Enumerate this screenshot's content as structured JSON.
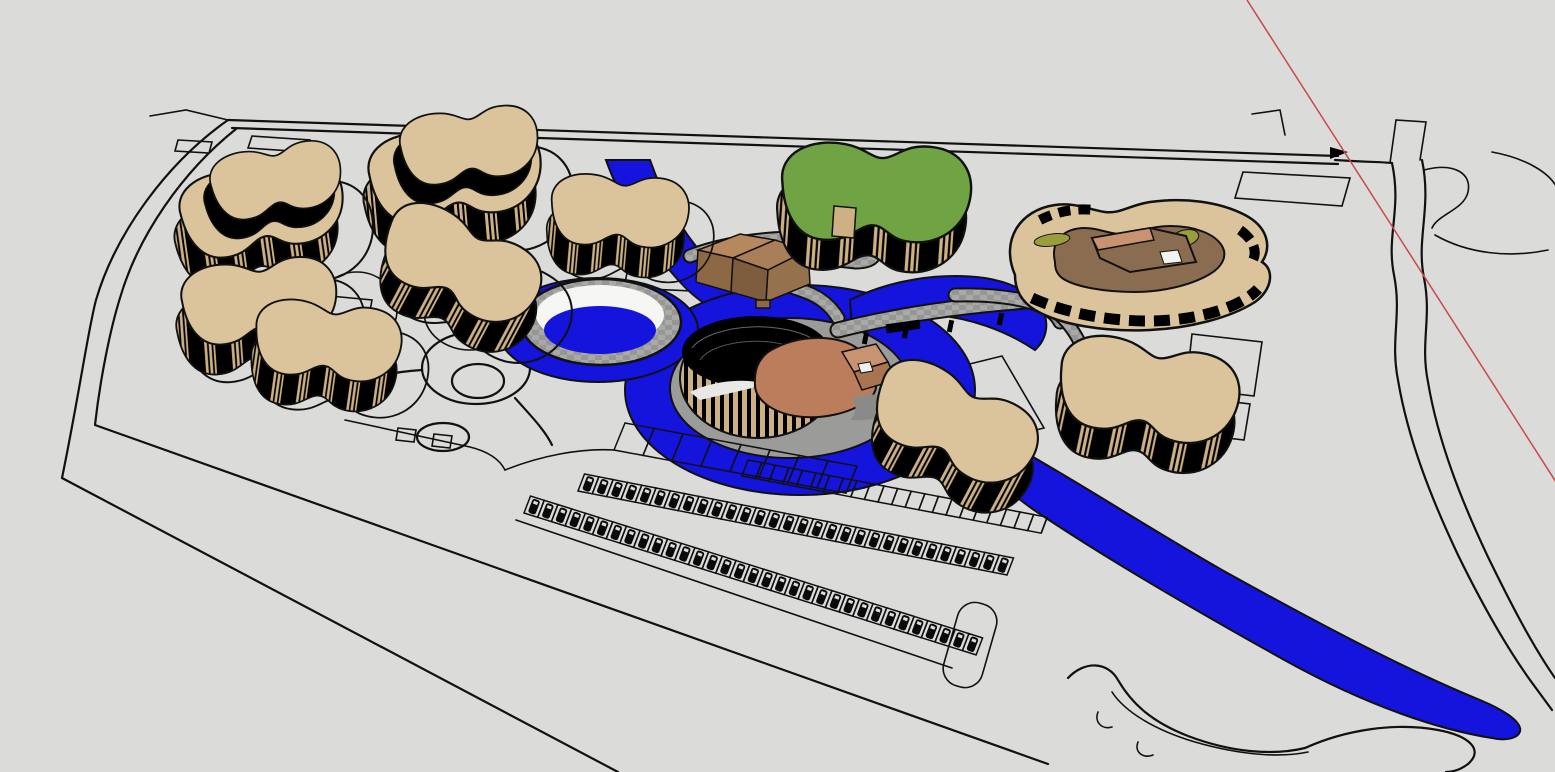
{
  "viewport": {
    "kind": "3d-model-viewport",
    "width": 1555,
    "height": 772,
    "scene_name": "resort-site-plan-model"
  },
  "colors": {
    "background": "#DBDBD9",
    "outline": "#111111",
    "building_tan": "#DBC49C",
    "building_tan_dark": "#CDB184",
    "green_roof": "#6FA343",
    "water": "#1414DC",
    "pool_white": "#F6F6F4",
    "stone": "#A9A9A7",
    "stone_dark": "#969694",
    "mound_gray": "#9B9B99",
    "courtyard_brown": "#8A6C51",
    "roof_salmon": "#BC7D5D",
    "roof_salmon_light": "#C99270",
    "pavilion_light": "#B5885E",
    "pavilion_mid": "#A87F58",
    "pavilion_dark": "#8C6845",
    "pavilion_side": "#96714E",
    "olive_green": "#9A9D3C",
    "axis_red": "#C84A4A",
    "car_black": "#0A0A0A",
    "white": "#FFFFFF"
  },
  "scene": {
    "axis_line": {
      "from_x": 1247,
      "from_y": 0,
      "to_x": 1556,
      "to_y": 482
    },
    "buildings": [
      {
        "name": "kidney-building-b",
        "cx": 448,
        "cy": 193,
        "rot": -5,
        "s": 1.0,
        "stacked": true,
        "pad": true
      },
      {
        "name": "kidney-building-c",
        "cx": 612,
        "cy": 230,
        "rot": 5,
        "s": 0.8,
        "stacked": false,
        "pad": true
      },
      {
        "name": "kidney-building-a",
        "cx": 255,
        "cy": 228,
        "rot": -8,
        "s": 0.95,
        "stacked": true,
        "pad": true
      },
      {
        "name": "kidney-building-e",
        "cx": 452,
        "cy": 283,
        "rot": 28,
        "s": 0.95,
        "stacked": false,
        "pad": true
      },
      {
        "name": "kidney-building-d",
        "cx": 252,
        "cy": 320,
        "rot": -4,
        "s": 0.9,
        "stacked": false,
        "pad": true
      },
      {
        "name": "kidney-building-f",
        "cx": 320,
        "cy": 360,
        "rot": 8,
        "s": 0.85,
        "stacked": false,
        "pad": true
      },
      {
        "name": "green-roof-building",
        "cx": 868,
        "cy": 213,
        "rot": 4,
        "s": 1.1,
        "top": "green_roof",
        "stacked": false,
        "pad": false
      },
      {
        "name": "kidney-building-g",
        "cx": 946,
        "cy": 442,
        "rot": 28,
        "s": 0.98,
        "stacked": false,
        "pad": false
      },
      {
        "name": "kidney-building-h",
        "cx": 1140,
        "cy": 410,
        "rot": 12,
        "s": 1.05,
        "stacked": false,
        "pad": false
      }
    ],
    "parking_rows": [
      {
        "name": "wide-stall-row",
        "type": "empty",
        "x": 614,
        "y": 450,
        "count": 8,
        "dx": 29,
        "dy": 5.4,
        "sx": 11,
        "sy": -27
      },
      {
        "name": "empty-stall-row",
        "type": "empty",
        "x": 742,
        "y": 476,
        "count": 22,
        "dx": 13.6,
        "dy": 2.6,
        "sx": 6,
        "sy": -16
      },
      {
        "name": "car-row-north",
        "type": "cars",
        "x": 578,
        "y": 491,
        "count": 30,
        "dx": 14.3,
        "dy": 2.8,
        "sx": 6.5,
        "sy": -17
      },
      {
        "name": "car-row-south",
        "type": "cars",
        "x": 524,
        "y": 513,
        "count": 33,
        "dx": 13.7,
        "dy": 4.3,
        "sx": 6.5,
        "sy": -17
      }
    ]
  }
}
